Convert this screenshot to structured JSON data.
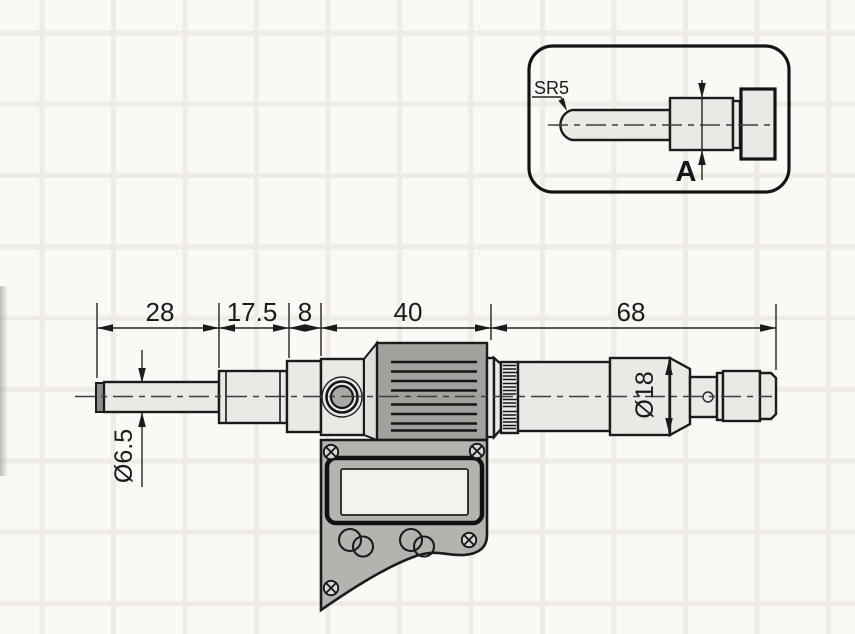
{
  "drawing": {
    "dimensions": {
      "horizontal": [
        {
          "label": "28"
        },
        {
          "label": "17.5"
        },
        {
          "label": "8"
        },
        {
          "label": "40"
        },
        {
          "label": "68"
        }
      ],
      "spindle_diameter": "Ø6.5",
      "thimble_diameter": "Ø18"
    },
    "inset": {
      "tip_radius_label": "SR5",
      "face_dimension_label": "A"
    },
    "colors": {
      "background": "#faf9f6",
      "grid_line": "#efece7",
      "outline": "#1b1b1b",
      "metal_light": "#eae9e6",
      "body_gray": "#a2a19e",
      "plate_gray": "#b4b3b0",
      "lcd_light": "#f3f2ef",
      "tip_gray": "#8d8d8b"
    }
  }
}
